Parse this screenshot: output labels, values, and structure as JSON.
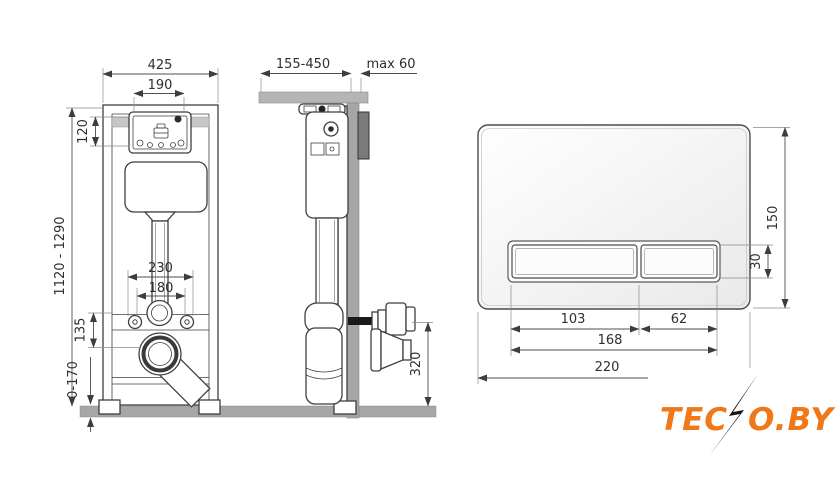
{
  "colors": {
    "line": "#3f3f3f",
    "dim_text": "#2e2e2e",
    "wall_gray": "#a6a6a6",
    "floor_gray": "#a6a6a6",
    "support_gray": "#b5b5b5",
    "bracket_gray": "#7a7a7a",
    "logo_orange": "#f07818",
    "logo_bolt": "#141414"
  },
  "front_view": {
    "dims": {
      "frame_width": "425",
      "service_window_width": "190",
      "service_window_height": "120",
      "spacing_outer": "230",
      "spacing_inner": "180",
      "outlet_offset": "135",
      "floor_adjust": "0-170",
      "frame_height": "1120 - 1290"
    }
  },
  "side_view": {
    "dims": {
      "depth_range": "155-450",
      "max_wall": "max 60",
      "outlet_height": "320"
    }
  },
  "plate_view": {
    "dims": {
      "plate_height": "150",
      "button_height": "30",
      "big_button_width": "103",
      "small_button_width": "62",
      "buttons_total_width": "168",
      "plate_width": "220"
    }
  },
  "logo": {
    "part1": "TEC",
    "part2": "O.BY",
    "name": "TECNO.BY"
  }
}
